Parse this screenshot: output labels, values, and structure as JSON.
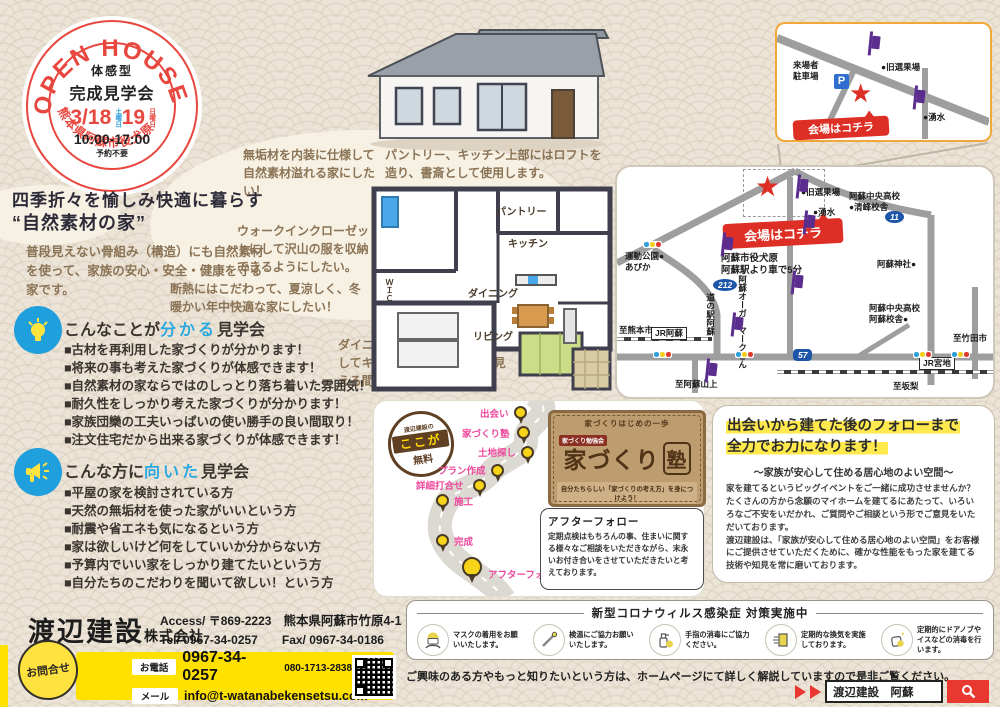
{
  "badge": {
    "arc_top": "OPEN HOUSE",
    "line1": "体感型",
    "line2": "完成見学会",
    "date1": "3/18",
    "day1": "土曜日",
    "date2": "19",
    "day2": "日曜日",
    "time": "10:00-17:00",
    "note": "予約不要",
    "arc_bottom": "熊本県阿蘇市役犬原"
  },
  "headline": {
    "line1": "四季折々を愉しみ快適に暮らす",
    "line2": "“自然素材の家”"
  },
  "intro": "普段見えない骨組み（構造）にも自然素材を使って、家族の安心・安全・健康を守る家です。",
  "notes": [
    "無垢材を内装に仕様して自然素材溢れる家にしたい！",
    "パントリー、キッチン上部にはロフトを造り、書斎として使用します。",
    "ウォークインクローゼットにして沢山の服を収納できるようにしたい。",
    "断熱にはこだわって、夏涼しく、冬暖かい年中快適な家にしたい！",
    "ダイニングとリビングを一体化してキッチンから家族の顔が見える間取りにしたい。"
  ],
  "floorplan": {
    "labels": [
      "パントリー",
      "キッチン",
      "ダイニング",
      "リビング",
      "ＷＩＣ"
    ]
  },
  "learn": {
    "title_pre": "こんなことが",
    "title_accent": "分かる",
    "title_post": "見学会",
    "items": [
      "■古材を再利用した家づくりが分かります！",
      "■将来の事も考えた家づくりが体感できます！",
      "■自然素材の家ならではのしっとり落ち着いた雰囲気！",
      "■耐久性をしっかり考えた家づくりが分かります！",
      "■家族団欒の工夫いっぱいの使い勝手の良い間取り！",
      "■注文住宅だから出来る家づくりが体感できます！"
    ]
  },
  "fit": {
    "title_pre": "こんな方に",
    "title_accent": "向いた",
    "title_post": "見学会",
    "items": [
      "■平屋の家を検討されている方",
      "■天然の無垢材を使った家がいいという方",
      "■耐震や省エネも気になるという方",
      "■家は欲しいけど何をしていいか分からない方",
      "■予算内でいい家をしっかり建てたいという方",
      "■自分たちのこだわりを聞いて欲しい！という方"
    ]
  },
  "inset_map": {
    "parking_line1": "来場者",
    "parking_line2": "駐車場",
    "p_mark": "P",
    "old_fruit_plant": "●旧選果場",
    "spring": "●湧水",
    "venue_ribbon": "会場はコチラ",
    "star": "★"
  },
  "main_map": {
    "venue_ribbon": "会場はコチラ",
    "star": "★",
    "address_line1": "阿蘇市役犬原",
    "address_line2": "阿蘇駅より車で5分",
    "labels": {
      "old_fruit_plant": "●旧選果場",
      "spring": "●湧水",
      "chuo_high_1a": "阿蘇中央高校",
      "chuo_high_1b": "●清峰校舎",
      "route11": "11",
      "aso_shrine": "阿蘇神社●",
      "chuo_high_2a": "阿蘇中央高校",
      "chuo_high_2b": "阿蘇校舎●",
      "sports_park": "運動公園●",
      "apika": "あぴか",
      "route212": "212",
      "michinoeki": "道の駅阿蘇",
      "jr_aso": "JR阿蘇",
      "to_kumamoto": "至熊本市",
      "route57": "57",
      "to_takeda": "至竹田市",
      "jr_miyaji": "JR宮地",
      "to_aso_sanjo": "至阿蘇山上",
      "to_sakanashi": "至坂梨",
      "organic_a": "阿蘇オーガー",
      "organic_b": "マークさん"
    }
  },
  "roadmap": {
    "badge": {
      "top": "渡辺建設の",
      "middle": "ここが",
      "bottom": "無料"
    },
    "steps": [
      "出会い",
      "家づくり塾",
      "土地探し",
      "プラン作成",
      "詳細打合せ",
      "施工",
      "完成",
      "アフターフォロー"
    ],
    "card": {
      "tagline": "家づくりはじめの一歩",
      "tag": "家づくり勉強会",
      "logo_main": "家づくり",
      "logo_juku": "塾",
      "caption": "自分たちらしい「家づくりの考え方」を身につけよう！"
    },
    "callout": {
      "title": "アフターフォロー",
      "body": "定期点検はもちろんの事、住まいに関する様々なご相談をいただきながら、末永いお付き合いをさせていただきたいと考えております。"
    }
  },
  "promise": {
    "title1": "出会いから建てた後のフォローまで",
    "title2": "全力でお力になります！",
    "subtitle": "～家族が安心して住める居心地のよい空間～",
    "body1": "家を建てるというビッグイベントをご一緒に成功させませんか？たくさんの方から念願のマイホームを建てるにあたって、いろいろなご不安をいだかれ、ご質問やご相談という形でご意見をいただいております。",
    "body2": "渡辺建設は、「家族が安心して住める居心地のよい空間」をお客様にご提供させていただくために、確かな性能をもった家を建てる技術や知見を常に磨いております。"
  },
  "company": {
    "name": "渡辺建設",
    "suffix": "株式会社",
    "access_label": "Access/",
    "postal": "〒869-2223",
    "address": "熊本県阿蘇市竹原4-1",
    "tel_label": "Tel/",
    "tel": "0967-34-0257",
    "fax_label": "Fax/",
    "fax": "0967-34-0186",
    "contact_badge": "お問合せ",
    "phone_label": "お電話",
    "phone_main": "0967-34-0257",
    "phone_mobile": "080-1713-2838（渡辺）",
    "mail_label": "メール",
    "email": "info@t-watanabekensetsu.com"
  },
  "covid": {
    "title": "新型コロナウィルス感染症 対策実施中",
    "items": [
      "マスクの着用をお願いいたします。",
      "検温にご協力お願いいたします。",
      "手指の消毒にご協力ください。",
      "定期的な換気を実施しております。",
      "定期的にドアノブやイスなどの消毒を行います。"
    ]
  },
  "footer": {
    "homepage_note": "ご興味のある方やもっと知りたいという方は、ホームページにて詳しく解説していますので是非ご覧ください。",
    "search_query": "渡辺建設　阿蘇"
  }
}
